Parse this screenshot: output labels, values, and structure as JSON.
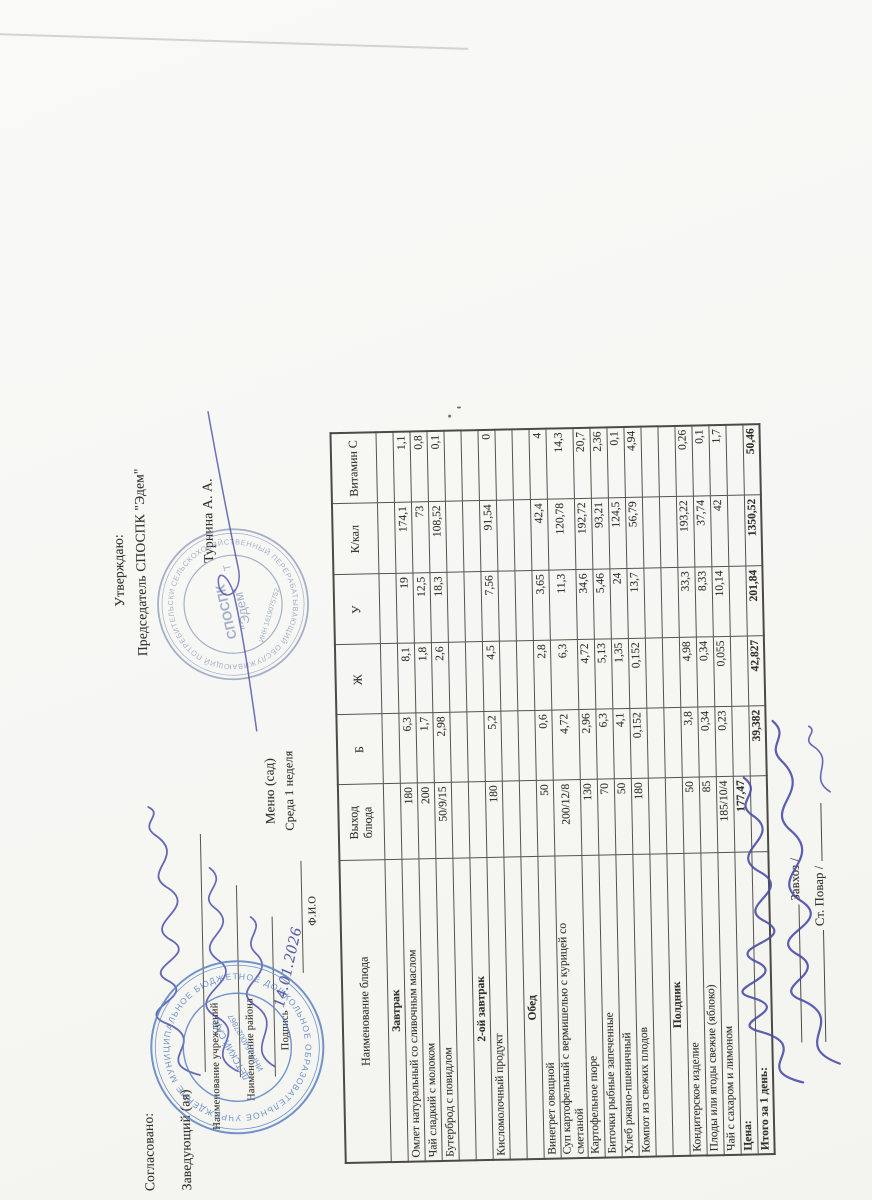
{
  "document": {
    "left_block": {
      "agreed": "Согласовано:",
      "head_label": "Заведующий (ая)",
      "institution_label": "Наименование учреждений",
      "district_label": "Наименование района",
      "signature_label": "Подпись",
      "fio_label": "Ф.И.О"
    },
    "center": {
      "title": "Меню (сад)",
      "subtitle": "Среда 1 неделя",
      "handwritten_date": "14.01.2026"
    },
    "right_block": {
      "approved": "Утверждаю:",
      "chairman": "Председатель СПОСПК \"Эдем\"",
      "chairman_name": "Турнина А. А."
    },
    "left_stamp": {
      "ring_text": "МУНИЦИПАЛЬНОЕ БЮДЖЕТНОЕ ДОШКОЛЬНОЕ ОБРАЗОВАТЕЛЬНОЕ УЧРЕЖДЕНИЕ *",
      "inner_text": "ИНН 1640027867",
      "center_text": "ДЕТСКИЙ САД"
    },
    "right_stamp": {
      "ring_text": "СЕЛЬСКОХОЗЯЙСТВЕННЫЙ ПЕРЕРАБАТЫВАЮЩИЙ ОБСЛУЖИВАЮЩИЙ ПОТРЕБИТЕЛЬСКИЙ КООПЕРАТИВ *",
      "inner_text": "ИНН 1619075752",
      "center_line1": "СПОСПК",
      "center_line2": "\"Эдем\"",
      "side_letter": "Т"
    },
    "footer": {
      "zavhoz_label": "Завхоз /",
      "cook_label": "Ст. Повар /"
    }
  },
  "table": {
    "columns": [
      "Наименование блюда",
      "Выход\nблюда",
      "Б",
      "Ж",
      "У",
      "К/кал",
      "Витамин С"
    ],
    "rows": [
      {
        "type": "section",
        "name": "Завтрак",
        "cells": [
          "",
          "",
          "",
          "",
          "",
          ""
        ]
      },
      {
        "type": "dish",
        "name": "Омлет натуральный со сливочным маслом",
        "cells": [
          "180",
          "6,3",
          "8,1",
          "19",
          "174,1",
          "1,1"
        ]
      },
      {
        "type": "dish",
        "name": "Чай сладкий с молоком",
        "cells": [
          "200",
          "1,7",
          "1,8",
          "12,5",
          "73",
          "0,8"
        ]
      },
      {
        "type": "dish",
        "name": "Бутерброд с повидлом",
        "cells": [
          "50/9/15",
          "2,98",
          "2,6",
          "18,3",
          "108,52",
          "0,1"
        ]
      },
      {
        "type": "empty",
        "name": "",
        "cells": [
          "",
          "",
          "",
          "",
          "",
          ""
        ]
      },
      {
        "type": "section",
        "name": "2-ой завтрак",
        "cells": [
          "",
          "",
          "",
          "",
          "",
          ""
        ]
      },
      {
        "type": "dish",
        "name": "Кисломолочный продукт",
        "cells": [
          "180",
          "5,2",
          "4,5",
          "7,56",
          "91,54",
          "0"
        ]
      },
      {
        "type": "empty",
        "name": "",
        "cells": [
          "",
          "",
          "",
          "",
          "",
          ""
        ]
      },
      {
        "type": "section",
        "name": "Обед",
        "cells": [
          "",
          "",
          "",
          "",
          "",
          ""
        ]
      },
      {
        "type": "dish",
        "name": "Винегрет овощной",
        "cells": [
          "50",
          "0,6",
          "2,8",
          "3,65",
          "42,4",
          "4"
        ]
      },
      {
        "type": "dish",
        "name": "Суп картофельный с вермишелью с курицей со\nсметаной",
        "cells": [
          "200/12/8",
          "4,72",
          "6,3",
          "11,3",
          "120,78",
          "14,3"
        ]
      },
      {
        "type": "dish",
        "name": "Картофельное пюре",
        "cells": [
          "130",
          "2,96",
          "4,72",
          "34,6",
          "192,72",
          "20,7"
        ]
      },
      {
        "type": "dish",
        "name": "Биточки рыбные запеченные",
        "cells": [
          "70",
          "6,3",
          "5,13",
          "5,46",
          "93,21",
          "2,36"
        ]
      },
      {
        "type": "dish",
        "name": "Хлеб ржано-пшеничный",
        "cells": [
          "50",
          "4,1",
          "1,35",
          "24",
          "124,5",
          "0,1"
        ]
      },
      {
        "type": "dish",
        "name": "Компот из свежих плодов",
        "cells": [
          "180",
          "0,152",
          "0,152",
          "13,7",
          "56,79",
          "4,94"
        ]
      },
      {
        "type": "empty",
        "name": "",
        "cells": [
          "",
          "",
          "",
          "",
          "",
          ""
        ]
      },
      {
        "type": "section",
        "name": "Полдник",
        "cells": [
          "",
          "",
          "",
          "",
          "",
          ""
        ]
      },
      {
        "type": "dish",
        "name": "Кондитерское изделие",
        "cells": [
          "50",
          "3,8",
          "4,98",
          "33,3",
          "193,22",
          "0,26"
        ]
      },
      {
        "type": "dish",
        "name": "Плоды или ягоды свежие (яблоко)",
        "cells": [
          "85",
          "0,34",
          "0,34",
          "8,33",
          "37,74",
          "0,1"
        ]
      },
      {
        "type": "dish",
        "name": "Чай с сахаром и лимоном",
        "cells": [
          "185/10/4",
          "0,23",
          "0,055",
          "10,14",
          "42",
          "1,7"
        ]
      },
      {
        "type": "price",
        "name": "Цена:",
        "cells": [
          "177,47",
          "",
          "",
          "",
          "",
          ""
        ]
      },
      {
        "type": "total",
        "name": "Итого за 1 день:",
        "cells": [
          "",
          "39,382",
          "42,827",
          "201,84",
          "1350,52",
          "50,46"
        ]
      }
    ]
  },
  "colors": {
    "paper": "#f8f8f5",
    "text": "#34322c",
    "table_line": "#56534b",
    "stamp_blue": "#5f86c6",
    "ink_blue": "#4a4ea9"
  }
}
